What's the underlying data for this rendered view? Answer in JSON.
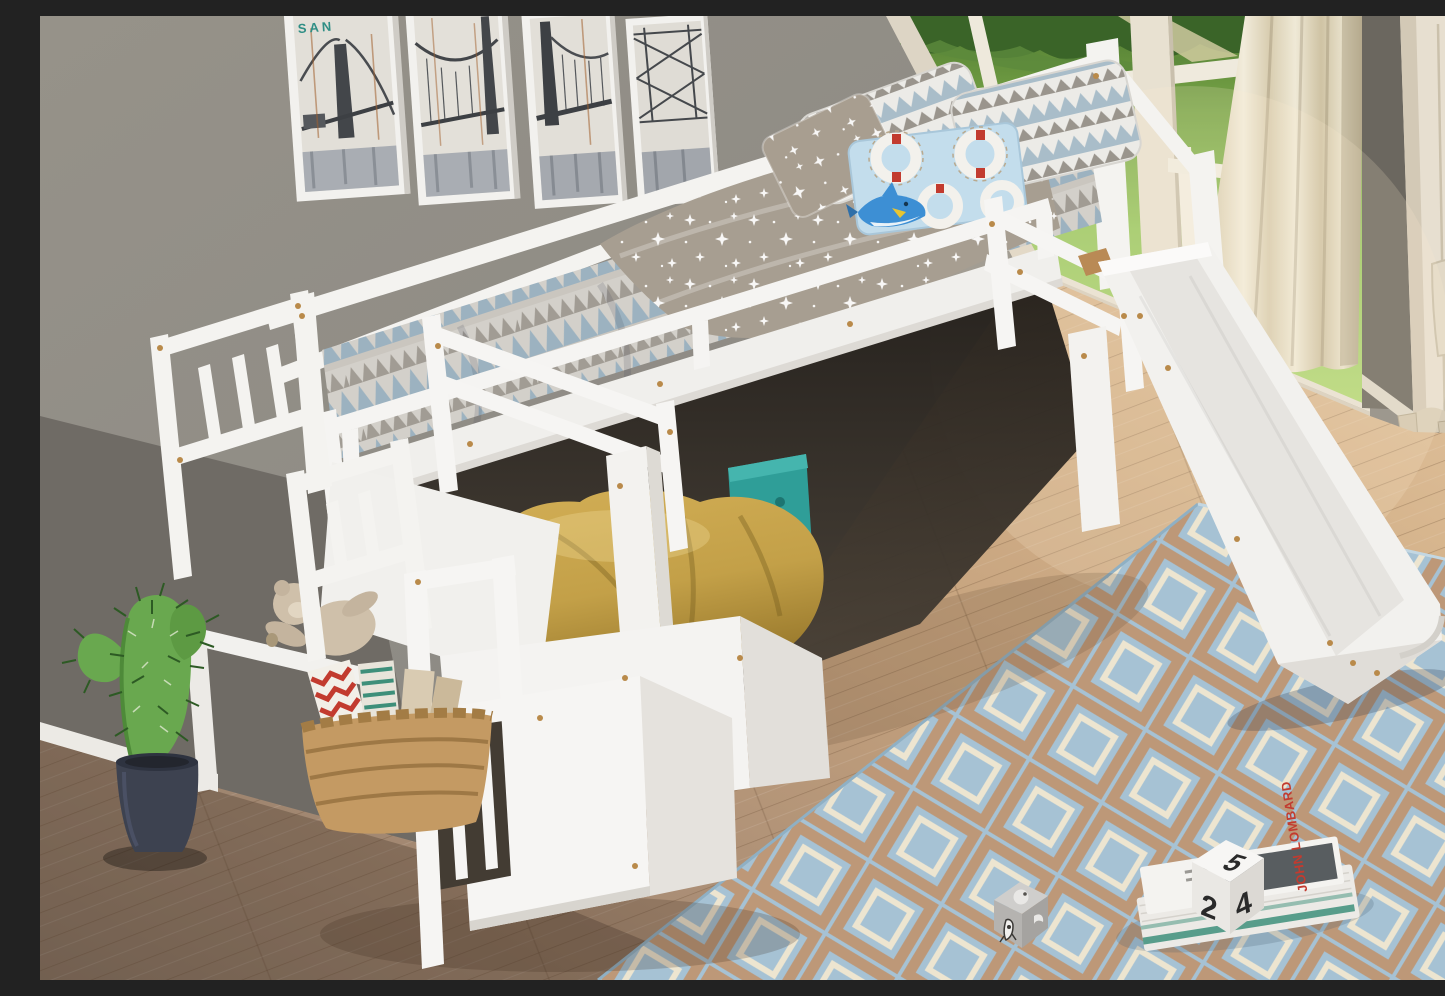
{
  "texts": {
    "poster_caption": "SAN",
    "book_spine": "JOHN LOMBARD",
    "die_top": "5",
    "die_left": "2",
    "die_right": "4"
  },
  "palette": {
    "wall": "#8d8a84",
    "wall_shadow": "#6f6b65",
    "bed_white": "#f4f3f0",
    "mattress_blue": "#9cb2c0",
    "mattress_gray": "#a19c94",
    "sheet_taupe": "#a79e91",
    "pillow_blue": "#a9bdc9",
    "lifebuoy_pillow_blue": "#c3ddec",
    "cushion_yellow": "#c3a048",
    "rug_blue": "#a6c2d4",
    "rug_tan": "#bd9878",
    "rug_cream": "#ede5d0",
    "grass_green": "#8fbf56",
    "curtain_cream": "#ece5d2",
    "wardrobe_cream": "#e7dfd0",
    "anchor_navy": "#2c3750",
    "cactus_green": "#69a84f",
    "pot_navy": "#3d4250",
    "basket_tan": "#c49a63",
    "book_teal": "#3e8f7a",
    "accent_red": "#c23b2f",
    "floor_light": "#d4b28a",
    "floor_dark": "#8a7665",
    "screw_gold": "#b98a4a"
  },
  "objects": {
    "scene": "Kids bedroom with white twin loft bed with slide and storage staircase",
    "posters": "Four framed black-and-white San Francisco bridge art prints on gray wall",
    "window_wall": "Cream French window wall with green garden view and palm trees",
    "curtain": "Cream floor-length curtain beside the window",
    "wardrobe": "Cream wardrobe with navy anchor panel and drawer, right edge of frame",
    "loft_bed": "White wooden low loft bed frame with guard rails",
    "mattress": "Mattress with blue-gray zigzag triangle pattern bedding",
    "sheet": "Taupe flat sheet with white stars draped over mattress",
    "pillow_zigzag_left": "White pillow with gray and blue mountain zigzag print",
    "pillow_zigzag_right": "Second zigzag mountain print pillow",
    "pillow_stars": "Taupe pillow with white stars",
    "pillow_lifebuoy": "Light blue pillow with life buoy rings and cartoon shark",
    "slide": "White wooden slide from loft down to the rug",
    "staircase": "White storage staircase with slatted railings",
    "box_steps": "White box storage steps at base of staircase",
    "shelf": "White open shelf in staircase holding a plush teddy bear",
    "teddy_bear": "Beige plush teddy bear lying on staircase shelf",
    "basket": "Woven wicker basket with magazines under the stairs",
    "bean_bag": "Mustard yellow bean bag cushion under the loft bed",
    "toy_box": "Teal toy box tucked under the bed",
    "cactus": "Decorative green cactus in a dark navy pot",
    "rug": "Blue area rug with tan and cream interlocking square trellis pattern",
    "books": "Two stacked picture books on the rug",
    "die_white": "White toy die showing 5, 2 and 4",
    "die_gray": "Gray toy die with rocket and planet icons",
    "floor": "Light oak hardwood plank floor",
    "baseboard": "White baseboard along the gray wall"
  }
}
